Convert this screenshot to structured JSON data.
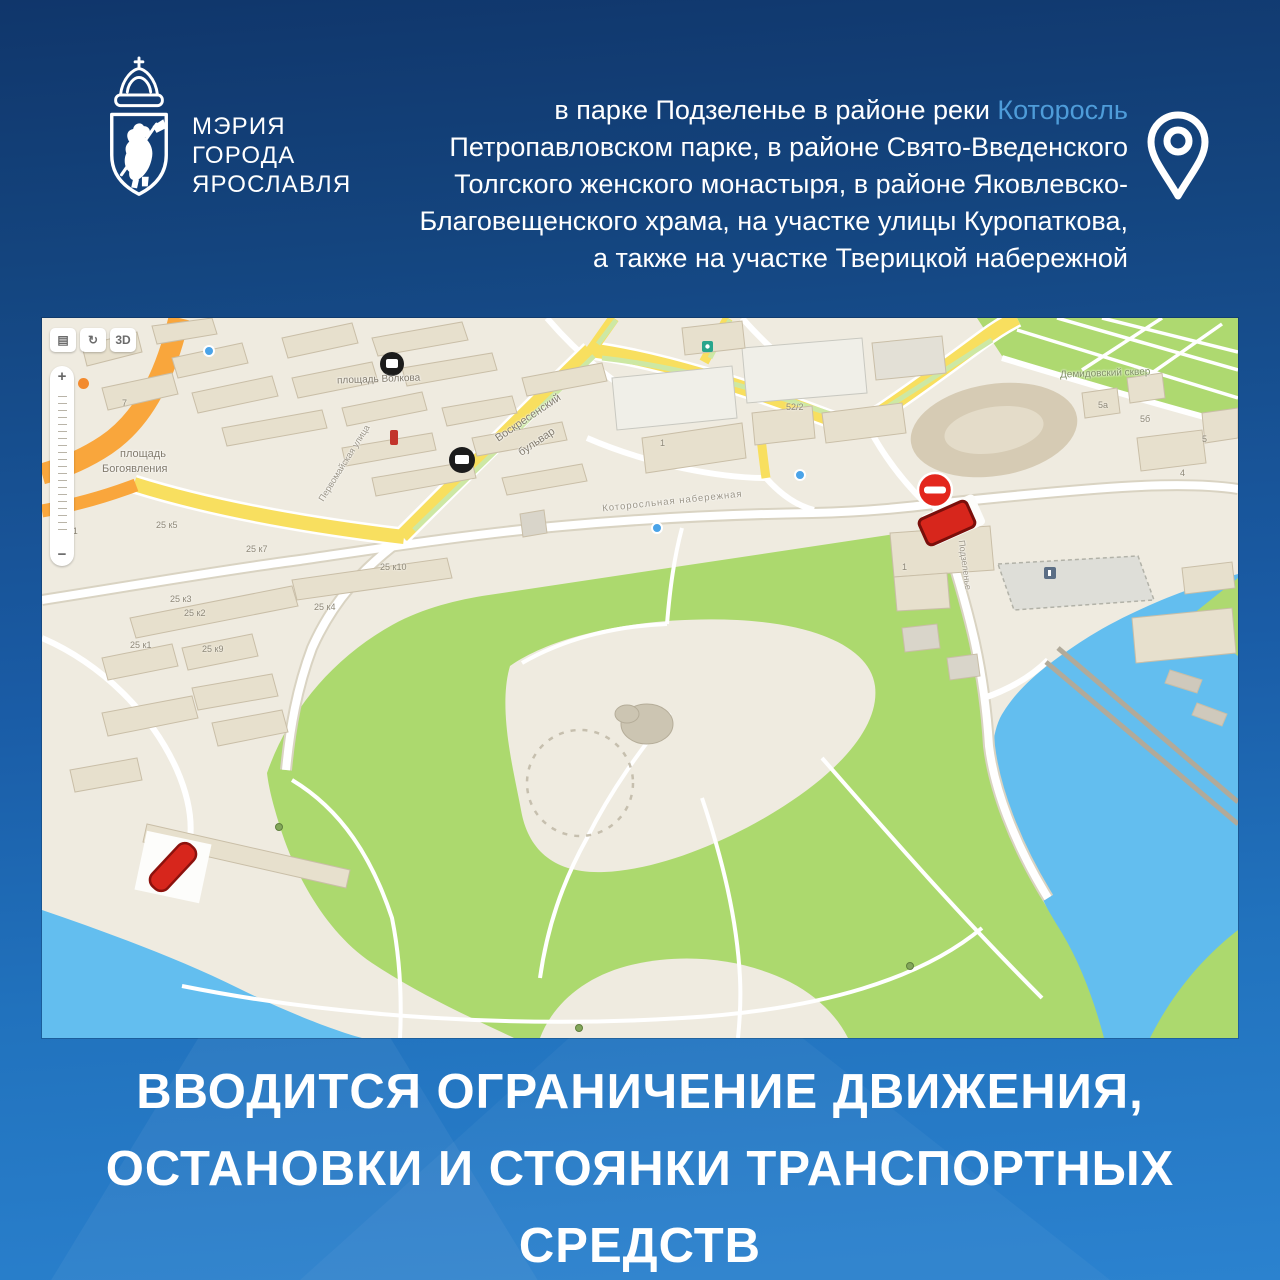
{
  "poster": {
    "logo": {
      "org_lines": [
        "МЭРИЯ",
        "ГОРОДА",
        "ЯРОСЛАВЛЯ"
      ]
    },
    "announcement": {
      "line1_prefix": "в парке Подзеленье в районе реки ",
      "line1_highlight": "Которосль",
      "highlight_color": "#4E9CD9",
      "lines_rest": [
        "Петропавловском парке, в районе Свято-Введенского",
        "Толгского женского монастыря, в районе Яковлевско-",
        "Благовещенского храма, на участке улицы Куропаткова,",
        "а также на участке Тверицкой набережной"
      ]
    },
    "headline_lines": [
      "ВВОДИТСЯ ОГРАНИЧЕНИЕ ДВИЖЕНИЯ,",
      "ОСТАНОВКИ И СТОЯНКИ ТРАНСПОРТНЫХ",
      "СРЕДСТВ"
    ],
    "colors": {
      "background_top": "#10366B",
      "background_bottom": "#2B82CF",
      "accent_red": "#D7261C"
    }
  },
  "map": {
    "controls": {
      "layers": "▤",
      "rotate": "↻",
      "btn_3d": "3D",
      "zoom_in": "+",
      "zoom_out": "−"
    },
    "place_labels": [
      "площадь",
      "Богоявления",
      "площадь Волкова",
      "Воскресенский",
      "бульвар",
      "Которосльная набережная",
      "Демидовский сквер",
      "Первомайская улица",
      "Подзеленье"
    ],
    "building_labels": [
      "7",
      "1",
      "52/2",
      "25 к11",
      "25 к5",
      "25 к7",
      "25 к10",
      "25 к4",
      "25 к3",
      "25 к2",
      "25 к9",
      "25 к1",
      "1",
      "4",
      "5",
      "5б",
      "5а"
    ]
  }
}
